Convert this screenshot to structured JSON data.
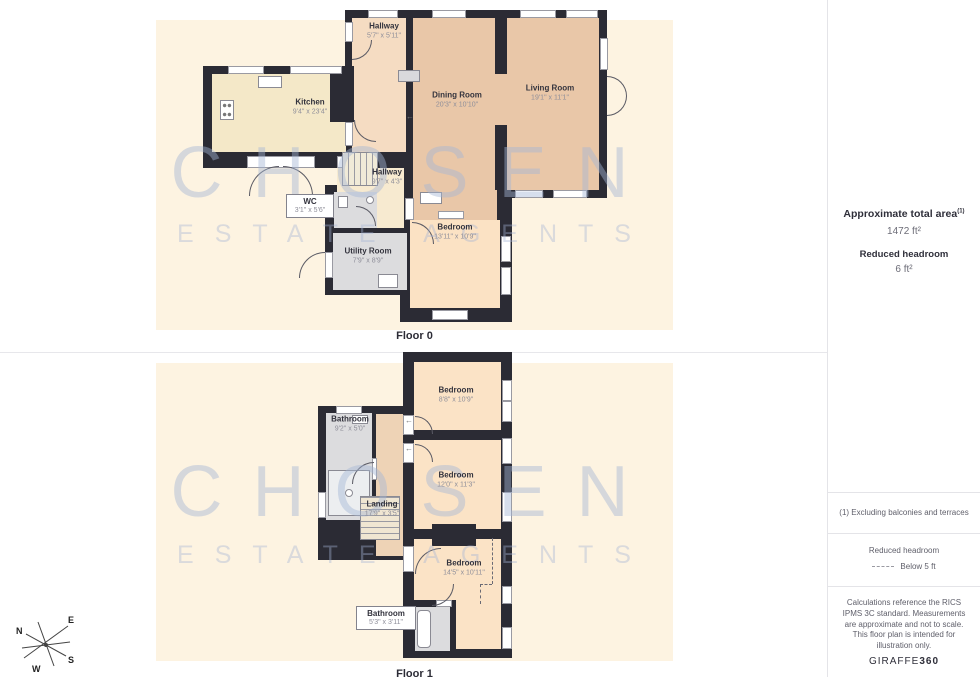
{
  "watermark": {
    "line1": "CHOSEN",
    "line2": "ESTATE AGENTS"
  },
  "floors": [
    {
      "label": "Floor 0",
      "rooms": [
        {
          "name": "Hallway",
          "dims": "5'7\" x 5'11\""
        },
        {
          "name": "Kitchen",
          "dims": "9'4\" x 23'4\""
        },
        {
          "name": "Dining Room",
          "dims": "20'3\" x 10'10\""
        },
        {
          "name": "Living Room",
          "dims": "19'1\" x 11'1\""
        },
        {
          "name": "Hallway",
          "dims": "9'7\" x 4'3\""
        },
        {
          "name": "WC",
          "dims": "3'1\" x 5'6\""
        },
        {
          "name": "Utility Room",
          "dims": "7'9\" x 8'9\""
        },
        {
          "name": "Bedroom",
          "dims": "13'11\" x 10'9\""
        }
      ]
    },
    {
      "label": "Floor 1",
      "rooms": [
        {
          "name": "Bedroom",
          "dims": "8'8\" x 10'9\""
        },
        {
          "name": "Bathroom",
          "dims": "9'2\" x 5'0\""
        },
        {
          "name": "Bedroom",
          "dims": "12'0\" x 11'3\""
        },
        {
          "name": "Landing",
          "dims": "17'9\" x 3'5\""
        },
        {
          "name": "Bedroom",
          "dims": "14'5\" x 10'11\""
        },
        {
          "name": "Bathroom",
          "dims": "5'3\" x 3'11\""
        }
      ]
    }
  ],
  "sidebar": {
    "total_area_label": "Approximate total area",
    "total_area_note": "(1)",
    "total_area_value": "1472 ft²",
    "reduced_headroom_label": "Reduced headroom",
    "reduced_headroom_value": "6 ft²",
    "footnote": "(1) Excluding balconies and terraces",
    "legend_label": "Reduced headroom",
    "legend_value": "Below 5 ft",
    "disclaimer": "Calculations reference the RICS IPMS 3C standard. Measurements are approximate and not to scale. This floor plan is intended for illustration only.",
    "brand": "GIRAFFE",
    "brand_bold": "360"
  },
  "compass": {
    "n": "N",
    "e": "E",
    "s": "S",
    "w": "W"
  },
  "colors": {
    "wall": "#2b2b34",
    "panel_cream": "#fdf3e1",
    "tan": "#e9c7a8",
    "peach": "#f8dfc2",
    "kitchen_cream": "#f4e8c8",
    "gray_room": "#dcdcde",
    "landing": "#eed3b6",
    "watermark": "#a4b5d4"
  }
}
